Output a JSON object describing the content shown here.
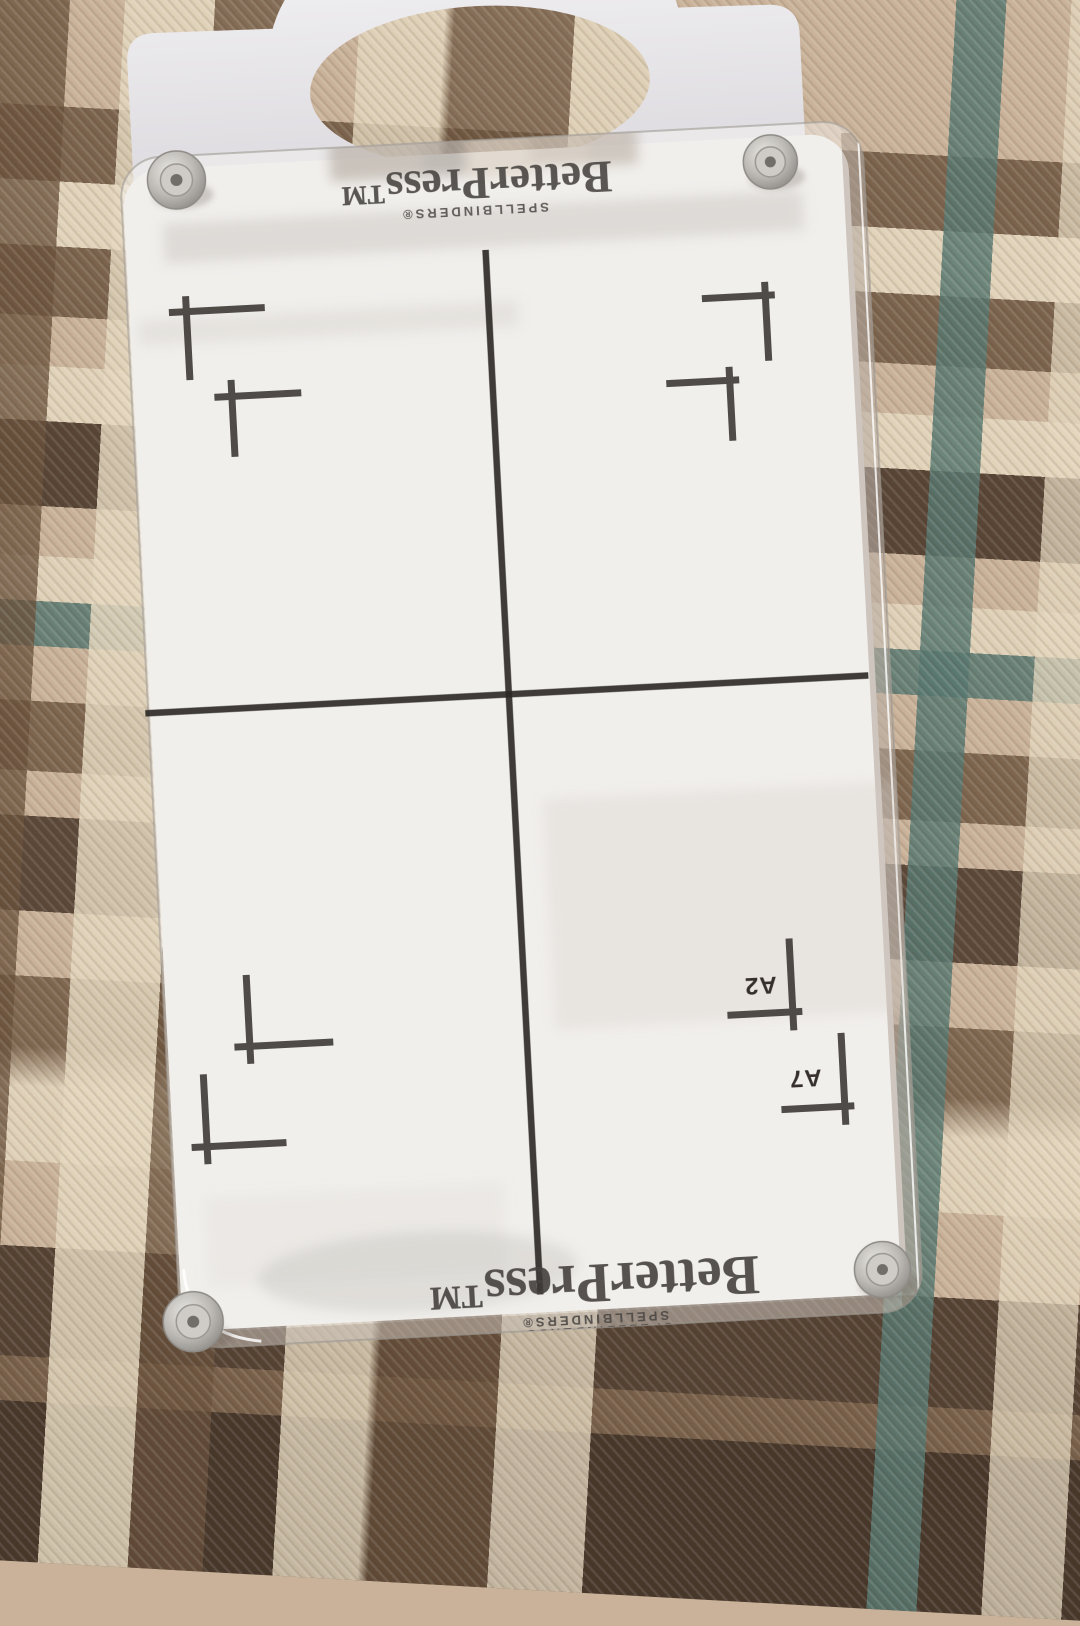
{
  "scene": {
    "background": "plaid-fabric",
    "object": "BetterPress letterpress registration plate with handle"
  },
  "plate": {
    "brand_top": "BetterPress™",
    "manufacturer_top": "SPELLBINDERS®",
    "brand_bottom": "BetterPress™",
    "manufacturer_bottom_line1": "SPELLBINDERS®",
    "manufacturer_bottom_line2": "SPELLBINDERS®",
    "size_labels": [
      "A2",
      "A7"
    ],
    "registration_marks": {
      "upper_left_quadrant": 2,
      "upper_right_quadrant": 2,
      "lower_left_quadrant": 2,
      "lower_right_quadrant": 2
    },
    "screws": 4
  },
  "colors": {
    "fabric_tan": "#c9b299",
    "fabric_cream": "#e4d7be",
    "fabric_brown": "#6a523c",
    "fabric_dark_brown": "#483628",
    "fabric_teal": "#587870",
    "plate_white": "#eceae7",
    "handle_white": "#ebe9ec",
    "line_black": "#2b2724",
    "screw_metal": "#b5b2ad"
  }
}
